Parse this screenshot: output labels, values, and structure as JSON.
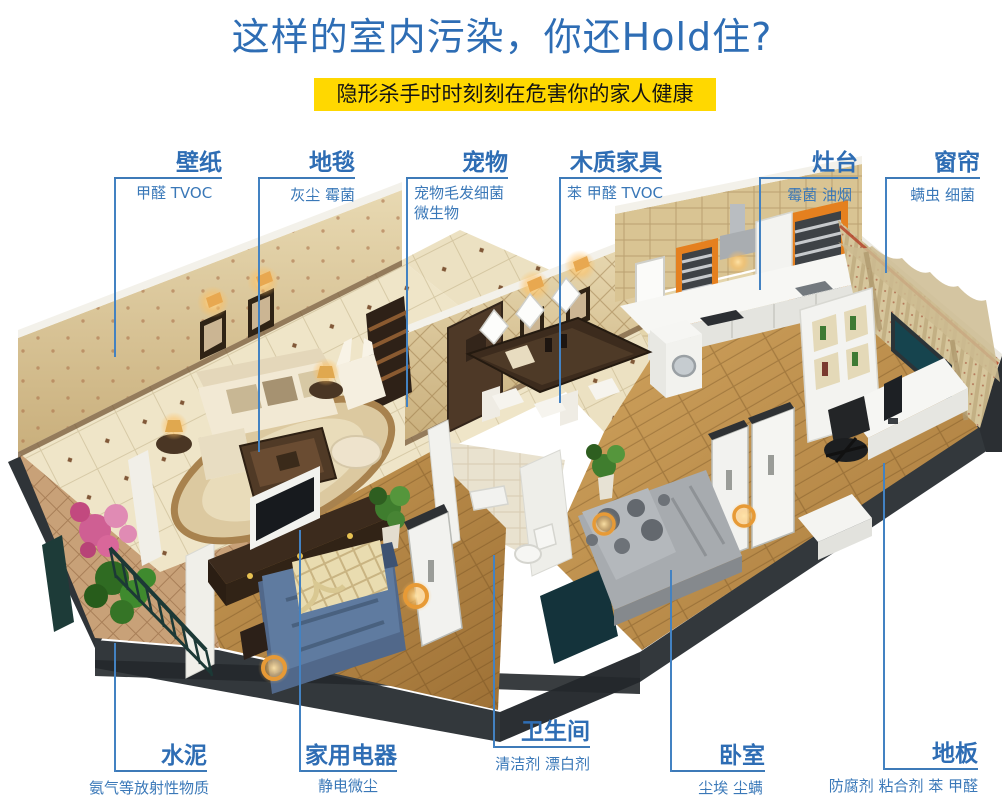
{
  "header": {
    "title": "这样的室内污染，你还Hold住?",
    "title_color": "#2e6db4",
    "banner": "隐形杀手时时刻刻在危害你的家人健康",
    "banner_bg": "#ffd800",
    "banner_text_color": "#141414"
  },
  "callouts": {
    "line_color": "#4382c2",
    "label_color": "#2e6db4",
    "top": [
      {
        "id": "wallpaper",
        "title": "壁纸",
        "sub": "甲醛 TVOC"
      },
      {
        "id": "carpet",
        "title": "地毯",
        "sub": "灰尘 霉菌"
      },
      {
        "id": "pet",
        "title": "宠物",
        "sub": "宠物毛发细菌 微生物"
      },
      {
        "id": "wood-furniture",
        "title": "木质家具",
        "sub": "苯 甲醛 TVOC"
      },
      {
        "id": "stove",
        "title": "灶台",
        "sub": "霉菌 油烟"
      },
      {
        "id": "curtain",
        "title": "窗帘",
        "sub": "螨虫 细菌"
      }
    ],
    "bottom": [
      {
        "id": "cement",
        "title": "水泥",
        "sub": "氨气等放射性物质"
      },
      {
        "id": "home-appliance",
        "title": "家用电器",
        "sub": "静电微尘"
      },
      {
        "id": "bathroom",
        "title": "卫生间",
        "sub": "清洁剂 漂白剂"
      },
      {
        "id": "bedroom",
        "title": "卧室",
        "sub": "尘埃 尘螨"
      },
      {
        "id": "floor",
        "title": "地板",
        "sub": "防腐剂 粘合剂 苯 甲醛"
      }
    ]
  },
  "illustration": {
    "name": "apartment-cutaway-3d",
    "description": "Isometric cutaway render of an apartment: living room with cream sofa and rug, entry with dark door, dining table, kitchen with orange-framed windows, bathroom, study with curtained window, balcony with plants, blue-bed bedroom and gray-bed bedroom",
    "palette": {
      "wall_tan": "#d9c493",
      "floor_cream": "#efe5c8",
      "floor_wood": "#c1924f",
      "kitchen_orange": "#e5801f",
      "bed_blue": "#5b7494",
      "bed_gray": "#a7abaf",
      "plant_green": "#3f7d2e",
      "flower_pink": "#d46a9d",
      "base_dark": "#33383c"
    }
  }
}
